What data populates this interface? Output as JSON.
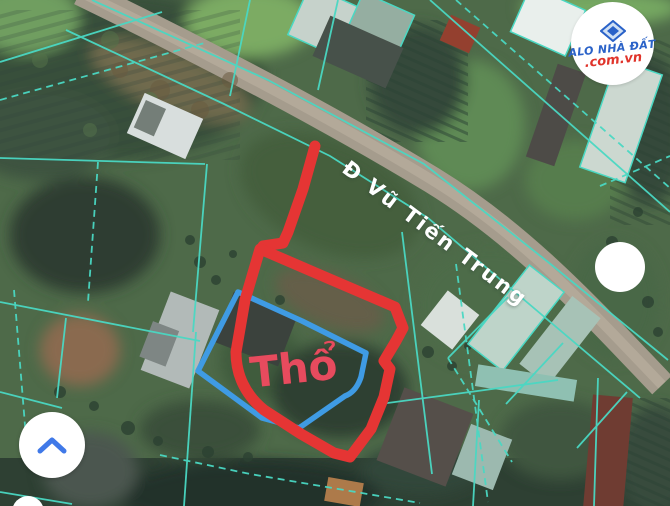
{
  "map": {
    "road_label": "Đ Vũ Tiến Trung",
    "plot_label": "Thổ",
    "colors": {
      "plot_outline_red": "#e53534",
      "inner_outline_blue": "#3f9be4",
      "parcel_line_teal": "#4ad8c3",
      "plot_label_red": "#e74b5e",
      "road_gray": "#a59c8d"
    }
  },
  "watermark": {
    "line1": "ALO NHÀ ĐẤT",
    "line2": ".com.vn",
    "icon": "diamond-logo-icon",
    "line1_color": "#2a62c8",
    "line2_color": "#e0342b"
  },
  "controls": {
    "collapse_button_icon": "chevron-up-icon",
    "right_circle_icon": "circle-marker"
  }
}
